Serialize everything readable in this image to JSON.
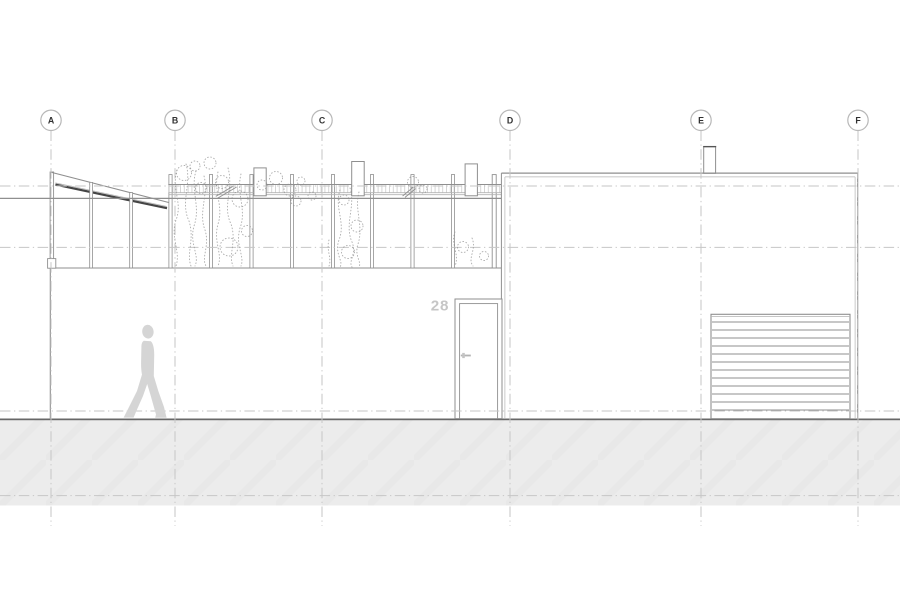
{
  "grid": {
    "labels": [
      "A",
      "B",
      "C",
      "D",
      "E",
      "F"
    ]
  },
  "door": {
    "number": "28"
  },
  "icons": {
    "figure": "walking-person-silhouette",
    "markers": "grid-bubble-circles"
  },
  "colors": {
    "line": "#8f8f8f",
    "line-dark": "#555555",
    "line-soft": "#b4b4b4",
    "canopy-dark": "#454545",
    "grid-line": "#c6c6c6",
    "marker-stroke": "#b8b8b8",
    "marker-text": "#303030",
    "ground-line": "#686868",
    "ground-fill": "#ececec",
    "ground-texture": "#e5e5e5",
    "figure": "#d5d5d5",
    "vegetation": "#8f8f8f",
    "door-number": "#c6c6c6",
    "hatch-tick": "#cccccc"
  }
}
